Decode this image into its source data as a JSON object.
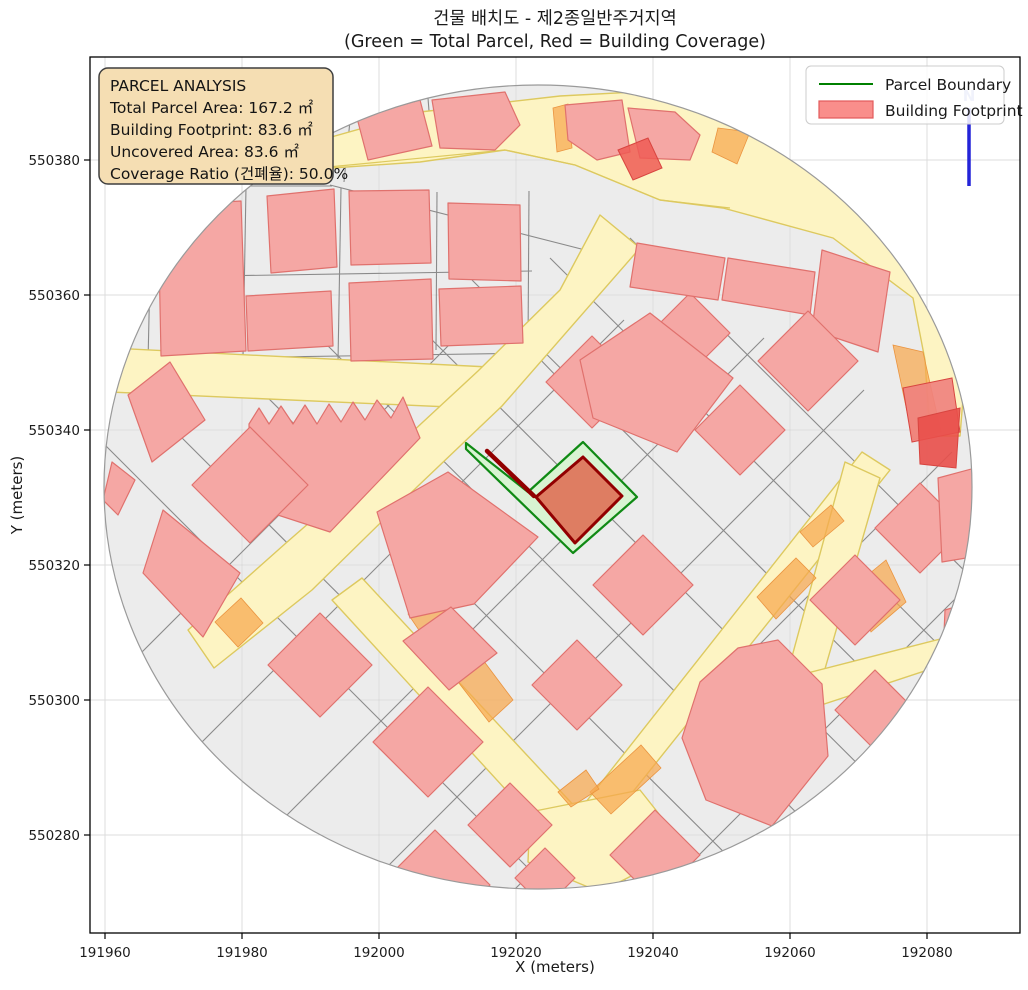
{
  "figure": {
    "bg": "#ffffff"
  },
  "title": {
    "line1": "건물 배치도 - 제2종일반주거지역",
    "line2": "(Green = Total Parcel, Red = Building Coverage)"
  },
  "axes": {
    "xlabel": "X (meters)",
    "ylabel": "Y (meters)",
    "x_ticks": [
      "191960",
      "191980",
      "192000",
      "192020",
      "192040",
      "192060",
      "192080"
    ],
    "y_ticks": [
      "550380",
      "550360",
      "550340",
      "550320",
      "550300",
      "550280"
    ],
    "x_tick_px": [
      105,
      242,
      379,
      516,
      653,
      790,
      927
    ],
    "y_tick_px": [
      160,
      295,
      430,
      565,
      700,
      835
    ],
    "rect": {
      "left": 90,
      "top": 57,
      "right": 1020,
      "bottom": 933
    }
  },
  "legend": {
    "items": [
      {
        "label": "Parcel Boundary",
        "symbol": "line",
        "color": "#008000"
      },
      {
        "label": "Building Footprint",
        "symbol": "patch",
        "fill": "#f98e8b",
        "stroke": "#e25a5a"
      }
    ]
  },
  "annotation": {
    "bg": "#f5deb3",
    "border": "#3f3f3f",
    "lines": [
      "PARCEL ANALYSIS",
      "Total Parcel Area: 167.2 ㎡",
      "Building Footprint: 83.6 ㎡",
      "Uncovered Area: 83.6 ㎡",
      "Coverage Ratio (건폐율): 50.0%"
    ]
  },
  "north": {
    "label": "N",
    "arrow_color": "#2424d8",
    "label_color": "#9aa6e2"
  },
  "chart_data": {
    "type": "map",
    "title": "건물 배치도 - 제2종일반주거지역",
    "subtitle": "(Green = Total Parcel, Red = Building Coverage)",
    "zoning": "제2종일반주거지역",
    "total_parcel_area_m2": 167.2,
    "building_footprint_m2": 83.6,
    "uncovered_area_m2": 83.6,
    "coverage_ratio_pct": 50.0,
    "xlabel": "X (meters)",
    "ylabel": "Y (meters)",
    "x_range_m": [
      191957,
      192093
    ],
    "y_range_m": [
      550266,
      550395
    ],
    "x_tick_values": [
      191960,
      191980,
      192000,
      192020,
      192040,
      192060,
      192080
    ],
    "y_tick_values": [
      550380,
      550360,
      550340,
      550320,
      550300,
      550280
    ],
    "legend": [
      "Parcel Boundary",
      "Building Footprint"
    ],
    "grid": true,
    "map_extent": "circular clip ~60 m radius around parcel at approx (192025, 550332)"
  },
  "map": {
    "palette": {
      "map_bg": "#ececec",
      "parcel_line": "#8a8a8a",
      "road_fill": "#fdf4c3",
      "road_stroke": "#ddc95f",
      "orange": "#f7a84e",
      "orange_stroke": "#ea9440",
      "building_fill": "#f5a7a4",
      "building_stroke": "#e0716d",
      "green_fill": "#d8f4d2",
      "green_stroke": "#0f8a14",
      "footprint_fill": "#de7d62",
      "footprint_stroke": "#920000",
      "circle_stroke": "#9a9a9a",
      "grid": "#dcdcdc",
      "grid_over": "#b9b9b9",
      "spine": "#000000"
    },
    "circle": {
      "cx": 538,
      "cy": 487,
      "rx": 434,
      "ry": 402
    },
    "parcel_lines": [
      [
        152,
        186,
        332,
        186
      ],
      [
        330,
        185,
        593,
        252
      ],
      [
        152,
        184,
        148,
        362
      ],
      [
        246,
        187,
        243,
        358
      ],
      [
        341,
        188,
        338,
        362
      ],
      [
        437,
        192,
        436,
        350
      ],
      [
        529,
        191,
        528,
        346
      ],
      [
        150,
        277,
        532,
        271
      ],
      [
        148,
        359,
        534,
        353
      ],
      [
        534,
        353,
        562,
        382
      ],
      [
        352,
        100,
        344,
        182
      ],
      [
        428,
        98,
        432,
        150
      ],
      [
        92,
        432,
        585,
        925
      ],
      [
        142,
        398,
        670,
        925
      ],
      [
        230,
        360,
        790,
        918
      ],
      [
        312,
        330,
        860,
        876
      ],
      [
        396,
        304,
        920,
        826
      ],
      [
        472,
        280,
        964,
        770
      ],
      [
        550,
        258,
        1002,
        708
      ],
      [
        630,
        238,
        1012,
        618
      ],
      [
        132,
        662,
        452,
        342
      ],
      [
        172,
        772,
        624,
        320
      ],
      [
        252,
        850,
        764,
        338
      ],
      [
        352,
        902,
        864,
        390
      ],
      [
        472,
        932,
        952,
        452
      ],
      [
        602,
        952,
        992,
        562
      ]
    ],
    "roads": [
      [
        303,
        145,
        420,
        112,
        560,
        96,
        672,
        90,
        770,
        108,
        856,
        152,
        914,
        218,
        952,
        292,
        966,
        362,
        960,
        436,
        930,
        436,
        925,
        360,
        913,
        298,
        833,
        238,
        723,
        208,
        660,
        200,
        575,
        165,
        505,
        150,
        420,
        162,
        303,
        170
      ],
      [
        110,
        348,
        489,
        367,
        472,
        408,
        110,
        392
      ],
      [
        600,
        215,
        640,
        248,
        502,
        406,
        418,
        486,
        312,
        590,
        214,
        668,
        188,
        630,
        286,
        543,
        396,
        447,
        478,
        371,
        560,
        290
      ],
      [
        332,
        600,
        362,
        578,
        578,
        810,
        550,
        838
      ],
      [
        551,
        840,
        578,
        812,
        862,
        452,
        890,
        470,
        580,
        858
      ],
      [
        530,
        812,
        640,
        790,
        686,
        848,
        600,
        892,
        528,
        862
      ],
      [
        845,
        462,
        880,
        478,
        816,
        700,
        784,
        686
      ],
      [
        788,
        678,
        952,
        636,
        958,
        660,
        800,
        712
      ]
    ],
    "road_edges": [
      [
        318,
        168,
        505,
        150,
        575,
        165,
        660,
        200,
        730,
        208
      ]
    ],
    "orange": [
      [
        553,
        108,
        568,
        104,
        572,
        148,
        557,
        152
      ],
      [
        718,
        128,
        750,
        132,
        737,
        164,
        712,
        152
      ],
      [
        893,
        345,
        923,
        352,
        941,
        432,
        913,
        440
      ],
      [
        853,
        587,
        886,
        560,
        906,
        602,
        871,
        632
      ],
      [
        408,
        614,
        433,
        592,
        472,
        648,
        446,
        670
      ],
      [
        452,
        674,
        477,
        652,
        513,
        700,
        489,
        722
      ],
      [
        590,
        792,
        641,
        745,
        661,
        768,
        611,
        814
      ],
      [
        757,
        597,
        796,
        558,
        816,
        578,
        776,
        619
      ],
      [
        800,
        532,
        831,
        505,
        844,
        521,
        813,
        547
      ],
      [
        215,
        622,
        241,
        598,
        263,
        623,
        238,
        647
      ],
      [
        558,
        792,
        586,
        770,
        599,
        789,
        571,
        807
      ]
    ],
    "buildings": [
      [
        357,
        118,
        420,
        100,
        432,
        146,
        368,
        160
      ],
      [
        432,
        100,
        505,
        92,
        520,
        125,
        495,
        150,
        440,
        148
      ],
      [
        565,
        105,
        622,
        100,
        630,
        152,
        597,
        160,
        568,
        140
      ],
      [
        628,
        108,
        675,
        112,
        700,
        135,
        690,
        160,
        640,
        158
      ],
      [
        267,
        196,
        334,
        189,
        337,
        267,
        271,
        273
      ],
      [
        349,
        191,
        429,
        190,
        431,
        263,
        351,
        265
      ],
      [
        448,
        203,
        520,
        205,
        521,
        281,
        449,
        279
      ],
      [
        246,
        296,
        331,
        291,
        333,
        346,
        248,
        351
      ],
      [
        349,
        283,
        431,
        279,
        433,
        359,
        351,
        361
      ],
      [
        439,
        289,
        521,
        286,
        523,
        343,
        441,
        346
      ],
      [
        158,
        206,
        241,
        201,
        246,
        351,
        161,
        356
      ],
      [
        106,
        181,
        156,
        176,
        159,
        246,
        108,
        251
      ],
      [
        128,
        395,
        170,
        362,
        205,
        420,
        152,
        462
      ],
      [
        249,
        424,
        259,
        408,
        269,
        424,
        281,
        406,
        293,
        424,
        305,
        405,
        317,
        424,
        329,
        404,
        341,
        422,
        353,
        402,
        365,
        420,
        377,
        400,
        391,
        418,
        403,
        397,
        420,
        438,
        330,
        532,
        250,
        506
      ],
      [
        192,
        485,
        250,
        427,
        308,
        485,
        250,
        543
      ],
      [
        163,
        510,
        240,
        573,
        203,
        637,
        143,
        573
      ],
      [
        112,
        462,
        135,
        480,
        118,
        515,
        103,
        500
      ],
      [
        268,
        665,
        320,
        613,
        372,
        665,
        320,
        717
      ],
      [
        373,
        742,
        428,
        687,
        483,
        742,
        428,
        797
      ],
      [
        377,
        512,
        448,
        472,
        538,
        537,
        474,
        604,
        410,
        618
      ],
      [
        403,
        641,
        451,
        607,
        497,
        653,
        449,
        690
      ],
      [
        546,
        382,
        592,
        336,
        638,
        382,
        592,
        428
      ],
      [
        650,
        333,
        690,
        293,
        730,
        333,
        690,
        373
      ],
      [
        695,
        430,
        740,
        385,
        785,
        430,
        740,
        475
      ],
      [
        593,
        585,
        643,
        535,
        693,
        585,
        643,
        635
      ],
      [
        532,
        685,
        577,
        640,
        622,
        685,
        577,
        730
      ],
      [
        700,
        682,
        738,
        648,
        778,
        640,
        822,
        684,
        828,
        756,
        772,
        826,
        706,
        800,
        682,
        738
      ],
      [
        810,
        600,
        855,
        555,
        900,
        600,
        855,
        645
      ],
      [
        875,
        528,
        920,
        483,
        965,
        528,
        920,
        573
      ],
      [
        637,
        243,
        725,
        258,
        718,
        300,
        630,
        287
      ],
      [
        728,
        258,
        815,
        272,
        810,
        315,
        722,
        300
      ],
      [
        822,
        250,
        890,
        272,
        878,
        352,
        812,
        330
      ],
      [
        580,
        360,
        650,
        313,
        733,
        378,
        677,
        452,
        593,
        418
      ],
      [
        758,
        361,
        808,
        311,
        858,
        361,
        808,
        411
      ],
      [
        835,
        710,
        875,
        670,
        915,
        710,
        875,
        750
      ],
      [
        610,
        855,
        655,
        810,
        700,
        855,
        655,
        900
      ],
      [
        380,
        885,
        435,
        830,
        490,
        885,
        435,
        940
      ],
      [
        468,
        825,
        510,
        783,
        552,
        825,
        510,
        867
      ],
      [
        938,
        478,
        975,
        468,
        978,
        556,
        942,
        562
      ],
      [
        945,
        610,
        978,
        600,
        975,
        652,
        943,
        656
      ],
      [
        515,
        878,
        545,
        848,
        575,
        878,
        545,
        908
      ]
    ],
    "red_buildings": [
      {
        "pts": [
          618,
          150,
          648,
          138,
          662,
          168,
          633,
          180
        ],
        "fill": "#ee5a55",
        "opacity": 0.85
      },
      {
        "pts": [
          903,
          388,
          952,
          378,
          960,
          432,
          912,
          442
        ],
        "fill": "#f0817d",
        "opacity": 0.9
      },
      {
        "pts": [
          918,
          418,
          960,
          408,
          956,
          468,
          920,
          464
        ],
        "fill": "#e94f4a",
        "opacity": 0.9
      }
    ],
    "highlight": {
      "parcel": [
        466,
        443,
        528,
        492,
        583,
        442,
        637,
        497,
        573,
        553,
        466,
        449
      ],
      "footprint": [
        583,
        457,
        622,
        496,
        575,
        543,
        536,
        497
      ],
      "arm": [
        487,
        451,
        534,
        496
      ]
    }
  }
}
